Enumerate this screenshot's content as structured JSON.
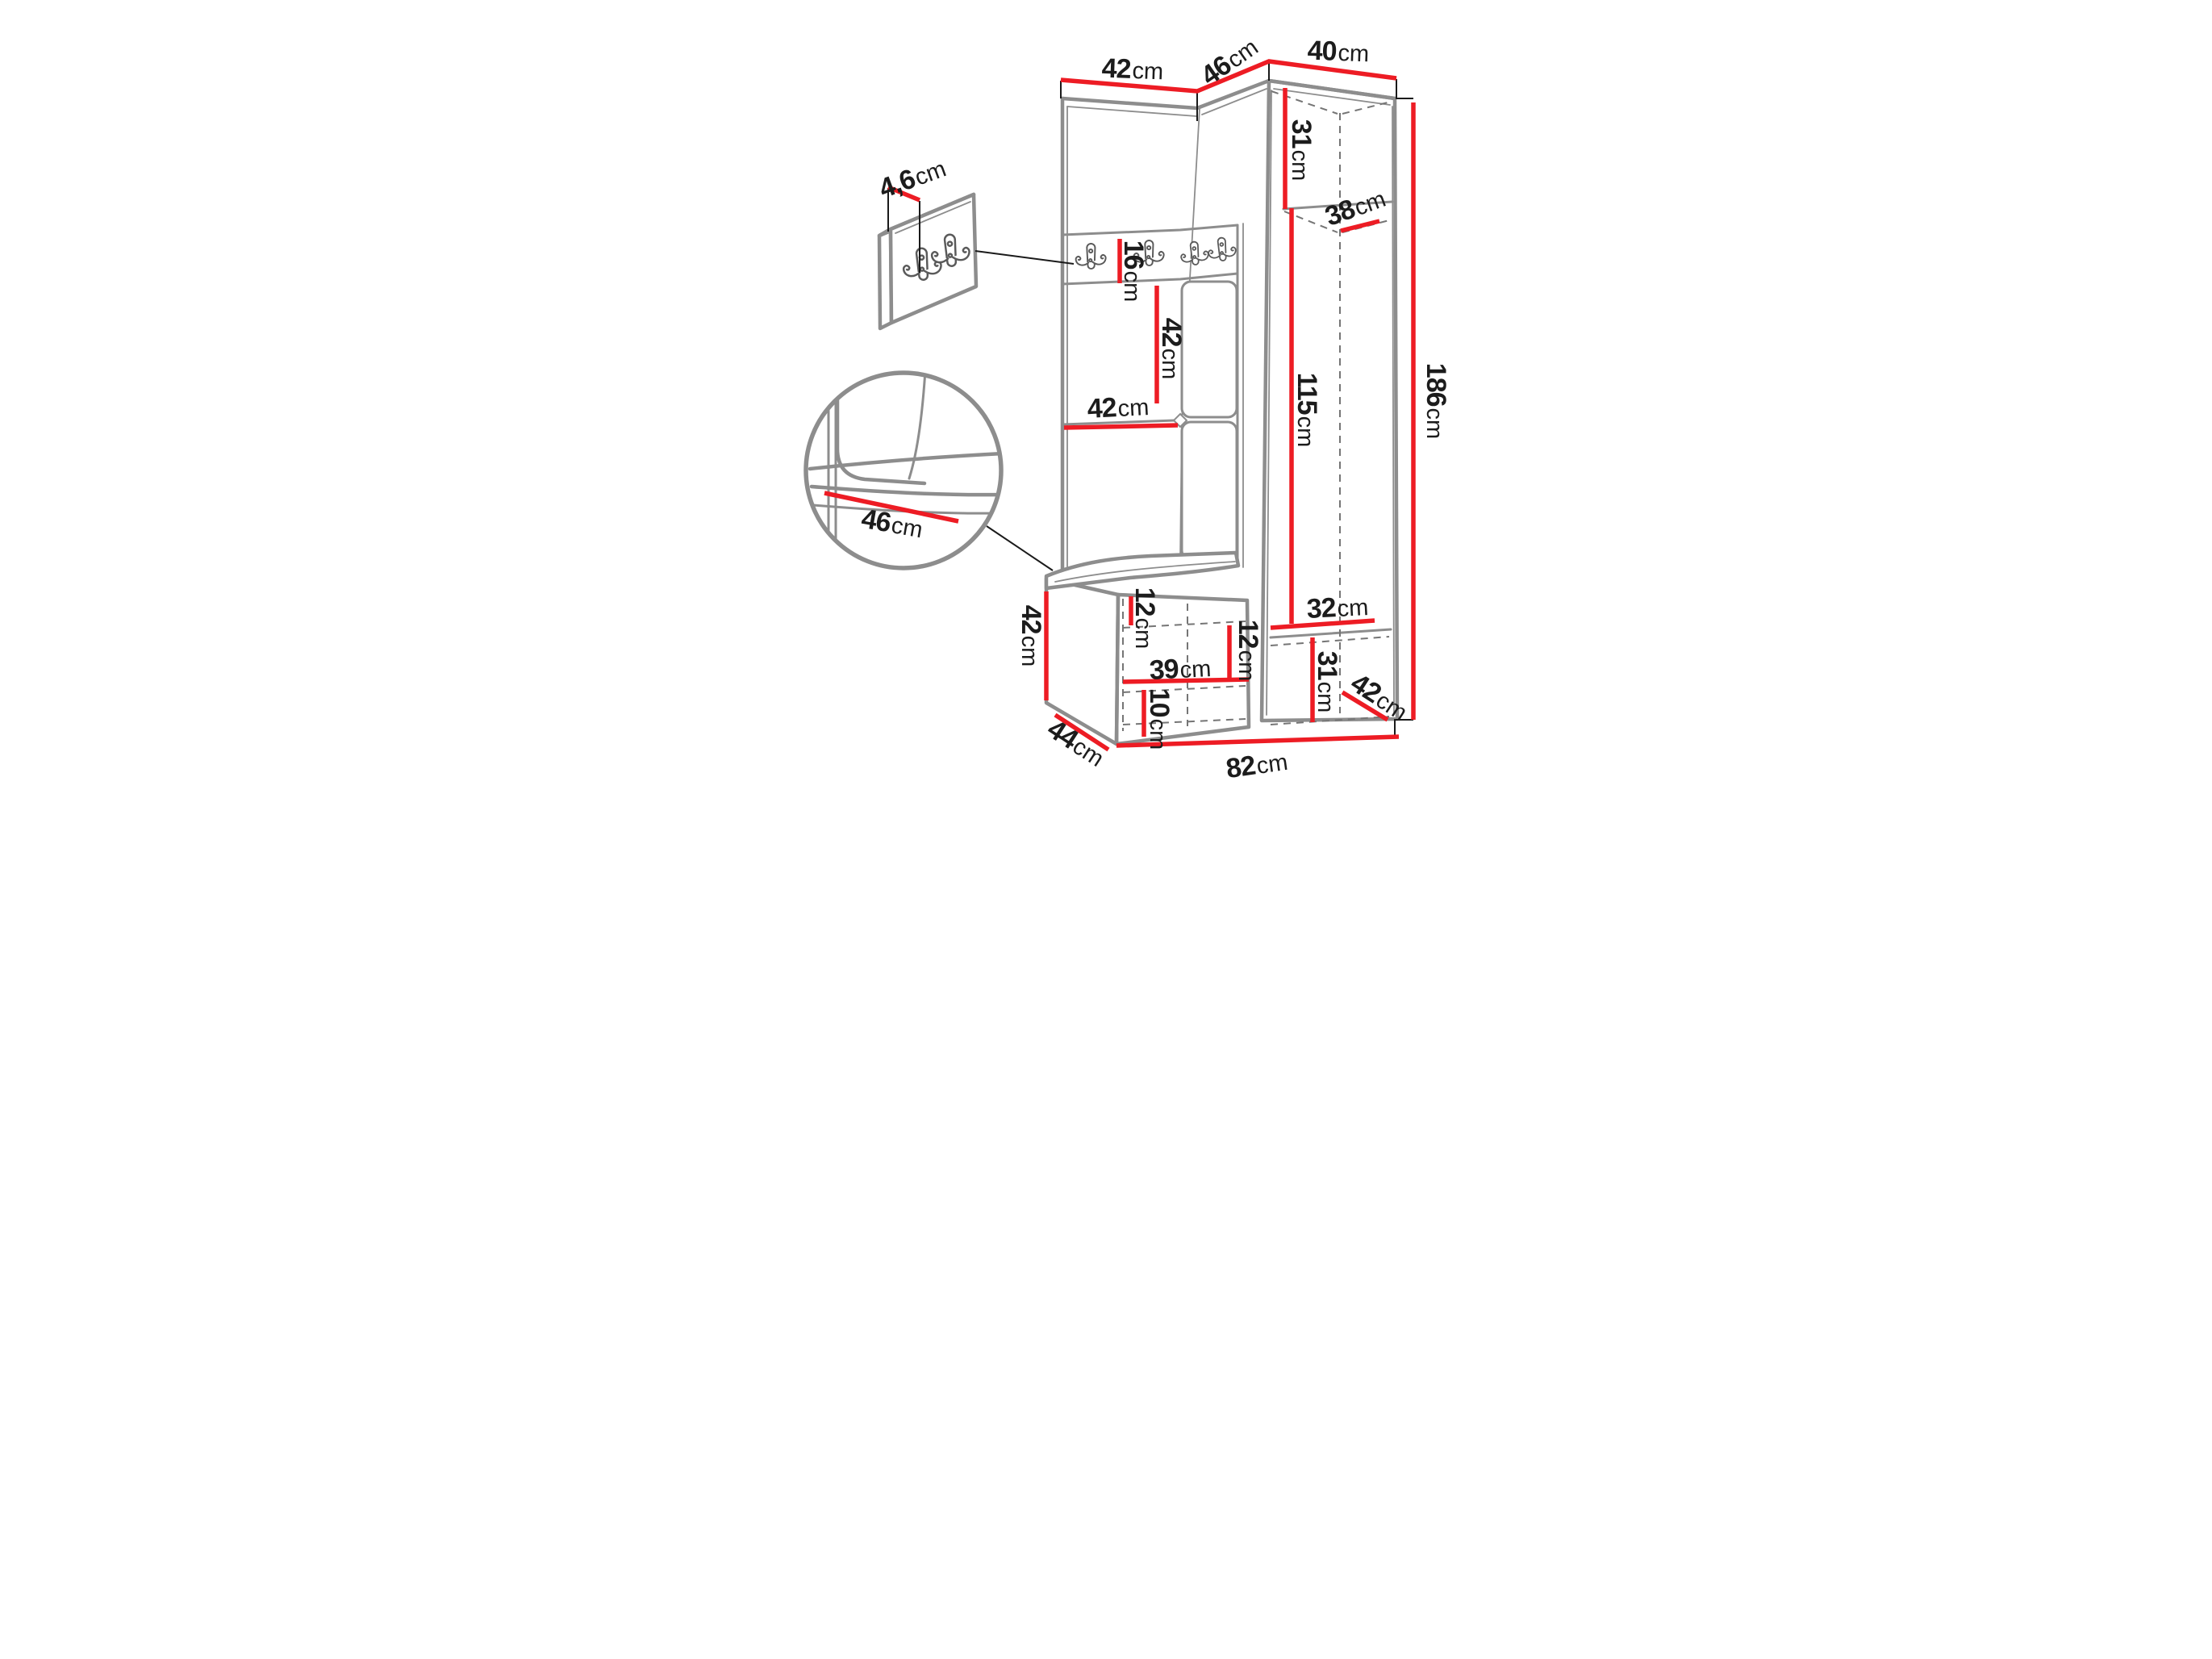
{
  "colors": {
    "dim_red": "#ed1c24",
    "furniture_gray": "#8d8d8d",
    "dash_gray": "#757575",
    "line_black": "#1a1a1a",
    "label_black": "#1c1c1c",
    "bg": "#ffffff"
  },
  "dimensions": {
    "top_left_width": {
      "value": "42",
      "unit": "cm"
    },
    "top_middle_width": {
      "value": "46",
      "unit": "cm"
    },
    "top_right_width": {
      "value": "40",
      "unit": "cm"
    },
    "hook_panel_thickness": {
      "value": "4,6",
      "unit": "cm"
    },
    "hook_strip_height": {
      "value": "16",
      "unit": "cm"
    },
    "back_panel_height": {
      "value": "42",
      "unit": "cm"
    },
    "niche_width": {
      "value": "42",
      "unit": "cm"
    },
    "top_shelf_height": {
      "value": "31",
      "unit": "cm"
    },
    "top_shelf_depth": {
      "value": "38",
      "unit": "cm"
    },
    "hanging_height": {
      "value": "115",
      "unit": "cm"
    },
    "total_height": {
      "value": "186",
      "unit": "cm"
    },
    "seat_width": {
      "value": "46",
      "unit": "cm"
    },
    "bench_height": {
      "value": "42",
      "unit": "cm"
    },
    "bench_depth": {
      "value": "44",
      "unit": "cm"
    },
    "bench_top_gap": {
      "value": "12",
      "unit": "cm"
    },
    "shelf_gap": {
      "value": "12",
      "unit": "cm"
    },
    "bench_inner_width": {
      "value": "39",
      "unit": "cm"
    },
    "bottom_gap": {
      "value": "10",
      "unit": "cm"
    },
    "lower_shelf_width": {
      "value": "32",
      "unit": "cm"
    },
    "lower_door_height": {
      "value": "31",
      "unit": "cm"
    },
    "lower_depth": {
      "value": "42",
      "unit": "cm"
    },
    "total_width": {
      "value": "82",
      "unit": "cm"
    }
  }
}
